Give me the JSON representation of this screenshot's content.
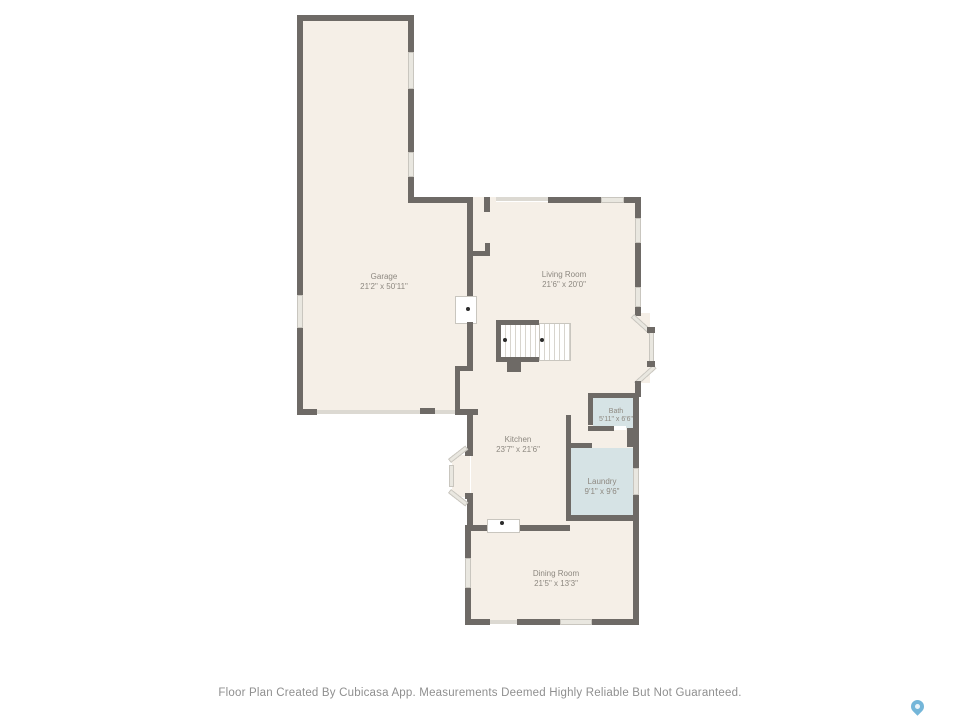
{
  "palette": {
    "background": "#ffffff",
    "wall": "#6e6a66",
    "floor": "#f5efe7",
    "wet_room": "#d6e3e5",
    "window": "#e9e7e0",
    "label_text": "#8d8880",
    "footer_text": "#8f8f8f",
    "pin_blue": "#74b6d9"
  },
  "rooms": [
    {
      "id": "garage",
      "name": "Garage",
      "dimensions": "21'2\" x 50'11\""
    },
    {
      "id": "living-room",
      "name": "Living Room",
      "dimensions": "21'6\" x 20'0\""
    },
    {
      "id": "kitchen",
      "name": "Kitchen",
      "dimensions": "23'7\" x 21'6\""
    },
    {
      "id": "bath",
      "name": "Bath",
      "dimensions": "5'11\" x 6'6\""
    },
    {
      "id": "laundry",
      "name": "Laundry",
      "dimensions": "9'1\" x 9'6\""
    },
    {
      "id": "dining-room",
      "name": "Dining Room",
      "dimensions": "21'5\" x 13'3\""
    }
  ],
  "footer": {
    "disclaimer": "Floor Plan Created By Cubicasa App. Measurements Deemed Highly Reliable But Not Guaranteed."
  },
  "branding": {
    "logo": "cubicasa-location-pin"
  }
}
